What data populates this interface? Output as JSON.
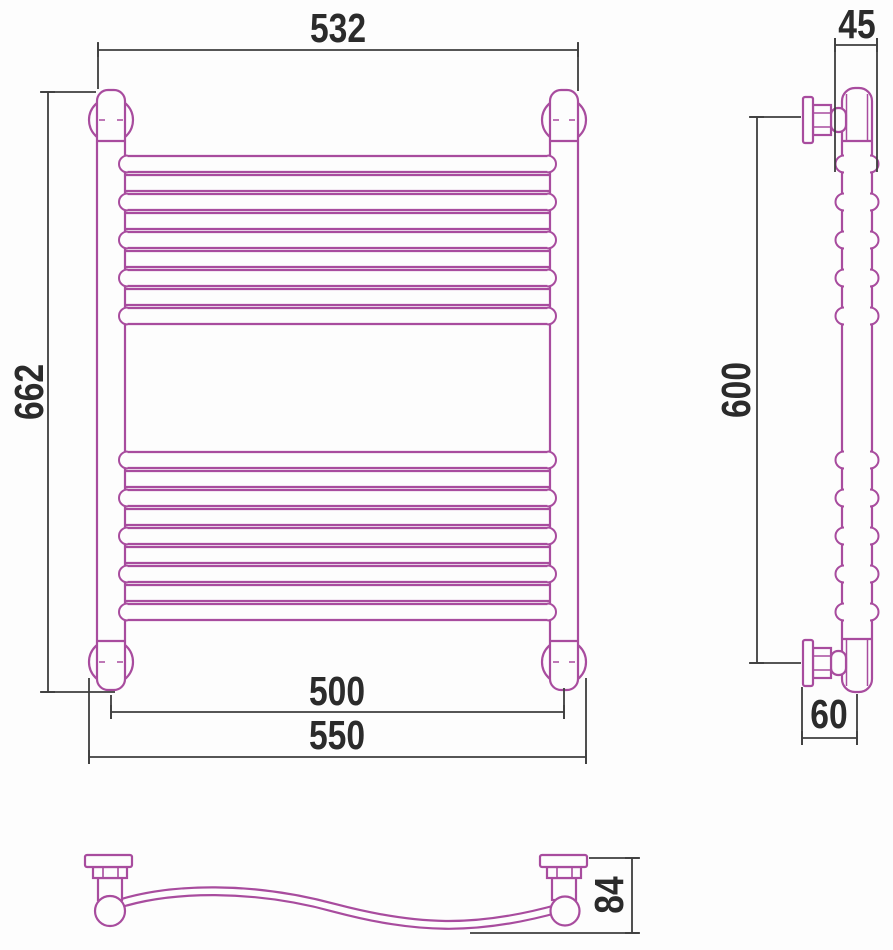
{
  "drawing": {
    "type": "technical-dimension-drawing",
    "subject": "wall-mounted wave towel rail, three orthographic views",
    "views": {
      "front": "front view with ladder rungs and four wall brackets",
      "side": "side profile with two wall brackets and rung bosses",
      "bottom": "bottom view showing S-curved (wave) rung"
    },
    "dimensions_mm": {
      "front_width_top": "532",
      "front_height": "662",
      "front_axes_width": "500",
      "front_overall_width": "550",
      "side_depth_top": "45",
      "side_height": "600",
      "side_bottom_depth": "60",
      "bottom_depth": "84"
    },
    "structure": {
      "rung_groups": 2,
      "rungs_per_group": 9,
      "wave_rungs_per_group": 5,
      "brackets_front": 4,
      "brackets_side": 2
    }
  },
  "colors": {
    "product_outline": "#A84C9E",
    "dimension_lines": "#3E3E3E",
    "label_text": "#2B2B2B",
    "background": "#FDFDFD"
  }
}
